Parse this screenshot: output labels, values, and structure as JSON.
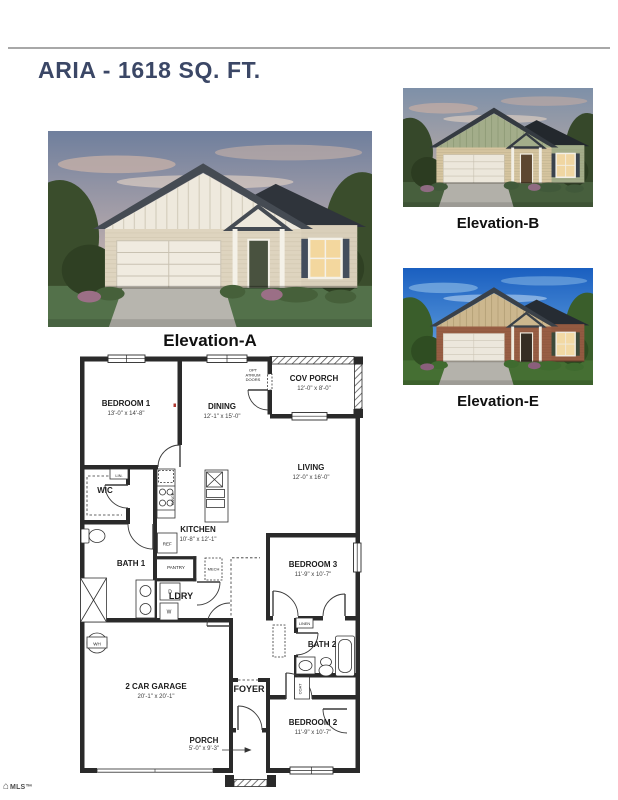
{
  "page": {
    "title": "ARIA - 1618 SQ. FT."
  },
  "elevations": [
    {
      "id": "A",
      "caption": "Elevation-A",
      "colors": {
        "sky_top": "#6f7f9d",
        "sky_mid": "#b3a7ab",
        "sky_bottom": "#e9cfb6",
        "cloud": "#c8b2a8",
        "cloud2": "#f0ddcb",
        "tree": "#3a4d2c",
        "tree2": "#2f4023",
        "grass": "#53714a",
        "driveway": "#b7b5ae",
        "roof": "#454b53",
        "roof_dark": "#2f343b",
        "gable": "#eee9dd",
        "batten": "#d6d0c0",
        "siding": "#ded4bf",
        "siding2": "#d9cfba",
        "siding_line": "#c4baa3",
        "garage_door": "#f0ebe0",
        "garage_line": "#c9c2b2",
        "trim": "#f4f1e8",
        "door": "#49523f",
        "shutter": "#434d5c",
        "window": "#f3d79e",
        "bush": "#46603a",
        "bush_accent": "#9b6f86"
      }
    },
    {
      "id": "B",
      "caption": "Elevation-B",
      "colors": {
        "sky_top": "#7e90a8",
        "sky_mid": "#a9a3a6",
        "sky_bottom": "#dec7b2",
        "cloud": "#c3aca4",
        "cloud2": "#ecd8c6",
        "tree": "#36482a",
        "tree2": "#2c3c21",
        "grass": "#475f3d",
        "driveway": "#b2b0a9",
        "roof": "#343a41",
        "roof_dark": "#23282d",
        "gable": "#a3ad8a",
        "batten": "#8c9873",
        "siding": "#d5c49f",
        "siding2": "#a3ad8a",
        "siding_line": "#94906f",
        "garage_door": "#ece7db",
        "garage_line": "#c6bfae",
        "trim": "#f2efe6",
        "door": "#5d4731",
        "shutter": "#39424c",
        "window": "#f0d6a2",
        "bush": "#41593a",
        "bush_accent": "#8f6b82"
      }
    },
    {
      "id": "E",
      "caption": "Elevation-E",
      "colors": {
        "sky_top": "#1a5fc0",
        "sky_mid": "#4f8fd6",
        "sky_bottom": "#a8cdf0",
        "cloud": "#7fb0e2",
        "cloud2": "#c4ddf4",
        "tree": "#3a5e2b",
        "tree2": "#2f4d22",
        "grass": "#456f33",
        "driveway": "#b4b2ab",
        "roof": "#3a4149",
        "roof_dark": "#262c33",
        "gable": "#ccb78e",
        "batten": "#b09c73",
        "siding": "#985e44",
        "siding2": "#935a41",
        "siding_line": "#7d4b36",
        "garage_door": "#ece7dc",
        "garage_line": "#cdc5b6",
        "trim": "#efeade",
        "door": "#352d23",
        "shutter": "#3c4a39",
        "window": "#f2d9a4",
        "bush": "#3f6b2f",
        "bush_accent": "#8a5f7b"
      }
    }
  ],
  "floorplan": {
    "rooms": [
      {
        "name": "BEDROOM 1",
        "dims": "13'-0\" x 14'-8\""
      },
      {
        "name": "DINING",
        "dims": "12'-1\" x 15'-0\""
      },
      {
        "name": "COV PORCH",
        "dims": "12'-0\" x 8'-0\""
      },
      {
        "name": "LIVING",
        "dims": "12'-0\" x 16'-0\""
      },
      {
        "name": "WIC",
        "dims": ""
      },
      {
        "name": "KITCHEN",
        "dims": "10'-8\" x 12'-1\""
      },
      {
        "name": "BATH 1",
        "dims": ""
      },
      {
        "name": "LDRY",
        "dims": ""
      },
      {
        "name": "BEDROOM 3",
        "dims": "11'-9\" x 10'-7\""
      },
      {
        "name": "2 CAR GARAGE",
        "dims": "20'-1\" x 20'-1\""
      },
      {
        "name": "FOYER",
        "dims": ""
      },
      {
        "name": "BATH 2",
        "dims": ""
      },
      {
        "name": "BEDROOM 2",
        "dims": "11'-9\" x 10'-7\""
      },
      {
        "name": "PORCH",
        "dims": "5'-0\" x 9'-3\""
      }
    ],
    "labels": {
      "opt1": "OPT",
      "opt2": "ATRIUM",
      "opt3": "DOORS",
      "lin": "LIN.",
      "pantry": "PANTRY",
      "mech": "MECH",
      "ref": "REF",
      "range": "RANGE",
      "dryer": "D",
      "washer": "W",
      "wh": "WH",
      "linen": "LINEN",
      "coat": "COAT"
    }
  },
  "footer": {
    "logo_text": "MLS™"
  }
}
